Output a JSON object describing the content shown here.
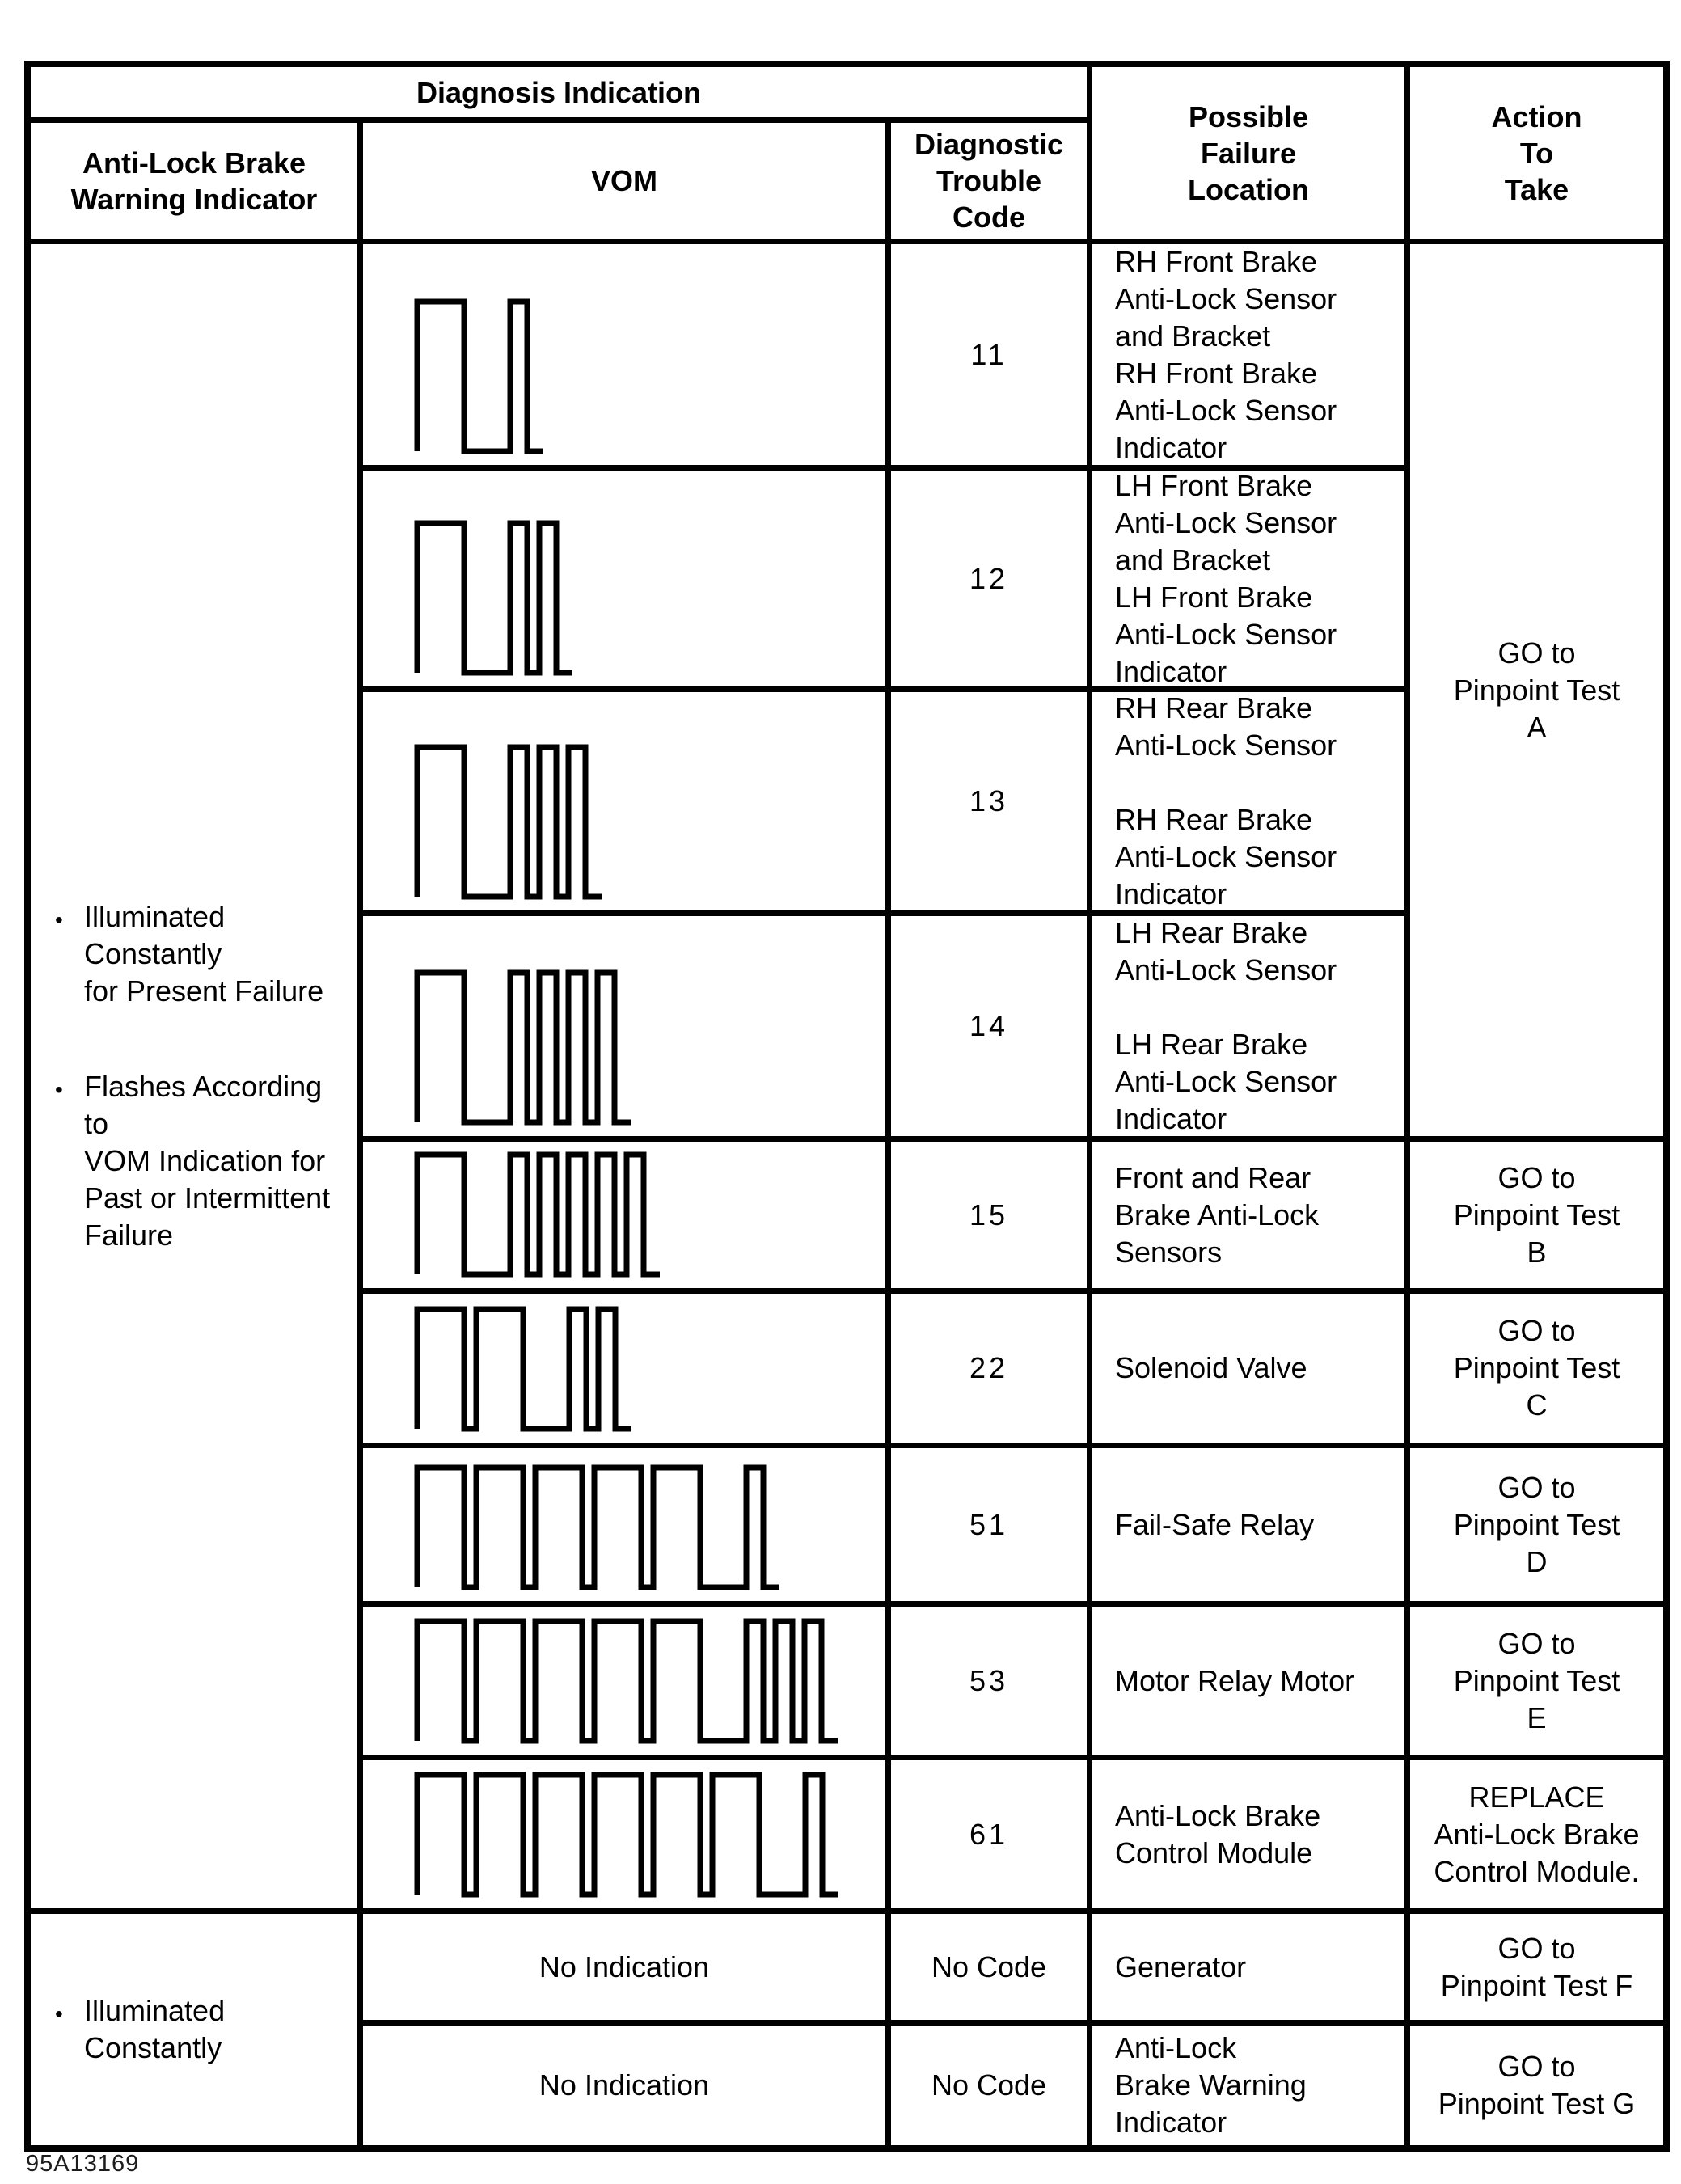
{
  "header": {
    "diagnosis_indication": "Diagnosis Indication",
    "columns": {
      "warning_indicator": [
        "Anti-Lock Brake",
        "Warning Indicator"
      ],
      "vom": "VOM",
      "diagnostic_trouble_code": [
        "Diagnostic",
        "Trouble",
        "Code"
      ],
      "possible_failure_location": [
        "Possible",
        "Failure",
        "Location"
      ],
      "action_to_take": [
        "Action",
        "To",
        "Take"
      ]
    }
  },
  "indicator": {
    "main_bullets": {
      "b1": [
        "Illuminated Constantly",
        "for Present Failure"
      ],
      "b2": [
        "Flashes According to",
        "VOM Indication for",
        "Past or Intermittent",
        "Failure"
      ]
    },
    "bottom_bullets": {
      "b1": [
        "Illuminated",
        "Constantly"
      ]
    }
  },
  "rows": {
    "r11": {
      "code": "11",
      "failure": [
        "RH Front Brake",
        "Anti-Lock Sensor",
        "and Bracket",
        "RH Front Brake",
        "Anti-Lock Sensor",
        "Indicator"
      ]
    },
    "r12": {
      "code": "12",
      "failure": [
        "LH Front Brake",
        "Anti-Lock Sensor",
        "and Bracket",
        "LH Front Brake",
        "Anti-Lock Sensor",
        "Indicator"
      ]
    },
    "r13": {
      "code": "13",
      "failure": [
        "RH Rear Brake",
        "Anti-Lock Sensor",
        "",
        "RH Rear Brake",
        "Anti-Lock Sensor",
        "Indicator"
      ]
    },
    "r14": {
      "code": "14",
      "failure": [
        "LH Rear Brake",
        "Anti-Lock Sensor",
        "",
        "LH Rear Brake",
        "Anti-Lock Sensor",
        "Indicator"
      ]
    },
    "r15": {
      "code": "15",
      "failure": [
        "Front and Rear",
        "Brake Anti-Lock",
        "Sensors"
      ],
      "action": [
        "GO to",
        "Pinpoint Test",
        "B"
      ]
    },
    "r22": {
      "code": "22",
      "failure": [
        "Solenoid Valve"
      ],
      "action": [
        "GO to",
        "Pinpoint Test",
        "C"
      ]
    },
    "r51": {
      "code": "51",
      "failure": [
        "Fail-Safe Relay"
      ],
      "action": [
        "GO to",
        "Pinpoint Test",
        "D"
      ]
    },
    "r53": {
      "code": "53",
      "failure": [
        "Motor Relay Motor"
      ],
      "action": [
        "GO to",
        "Pinpoint Test",
        "E"
      ]
    },
    "r61": {
      "code": "61",
      "failure": [
        "Anti-Lock Brake",
        "Control Module"
      ],
      "action": [
        "REPLACE",
        "Anti-Lock Brake",
        "Control Module."
      ]
    },
    "rF": {
      "code": "No Code",
      "vom": "No Indication",
      "failure": [
        "Generator"
      ],
      "action": [
        "GO to",
        "Pinpoint Test F"
      ]
    },
    "rG": {
      "code": "No Code",
      "vom": "No Indication",
      "failure": [
        "Anti-Lock",
        "Brake Warning Indicator"
      ],
      "action": [
        "GO to",
        "Pinpoint Test G"
      ]
    }
  },
  "actions_merged": {
    "codes_11_14": [
      "GO to",
      "Pinpoint Test",
      "A"
    ]
  },
  "waveforms": [
    {
      "code": "11",
      "long_pulses": 1,
      "short_pulses": 1
    },
    {
      "code": "12",
      "long_pulses": 1,
      "short_pulses": 2
    },
    {
      "code": "13",
      "long_pulses": 1,
      "short_pulses": 3
    },
    {
      "code": "14",
      "long_pulses": 1,
      "short_pulses": 4
    },
    {
      "code": "15",
      "long_pulses": 1,
      "short_pulses": 5
    },
    {
      "code": "22",
      "long_pulses": 2,
      "short_pulses": 2
    },
    {
      "code": "51",
      "long_pulses": 5,
      "short_pulses": 1
    },
    {
      "code": "53",
      "long_pulses": 5,
      "short_pulses": 3
    },
    {
      "code": "61",
      "long_pulses": 6,
      "short_pulses": 1
    }
  ],
  "caption": "95A13169"
}
